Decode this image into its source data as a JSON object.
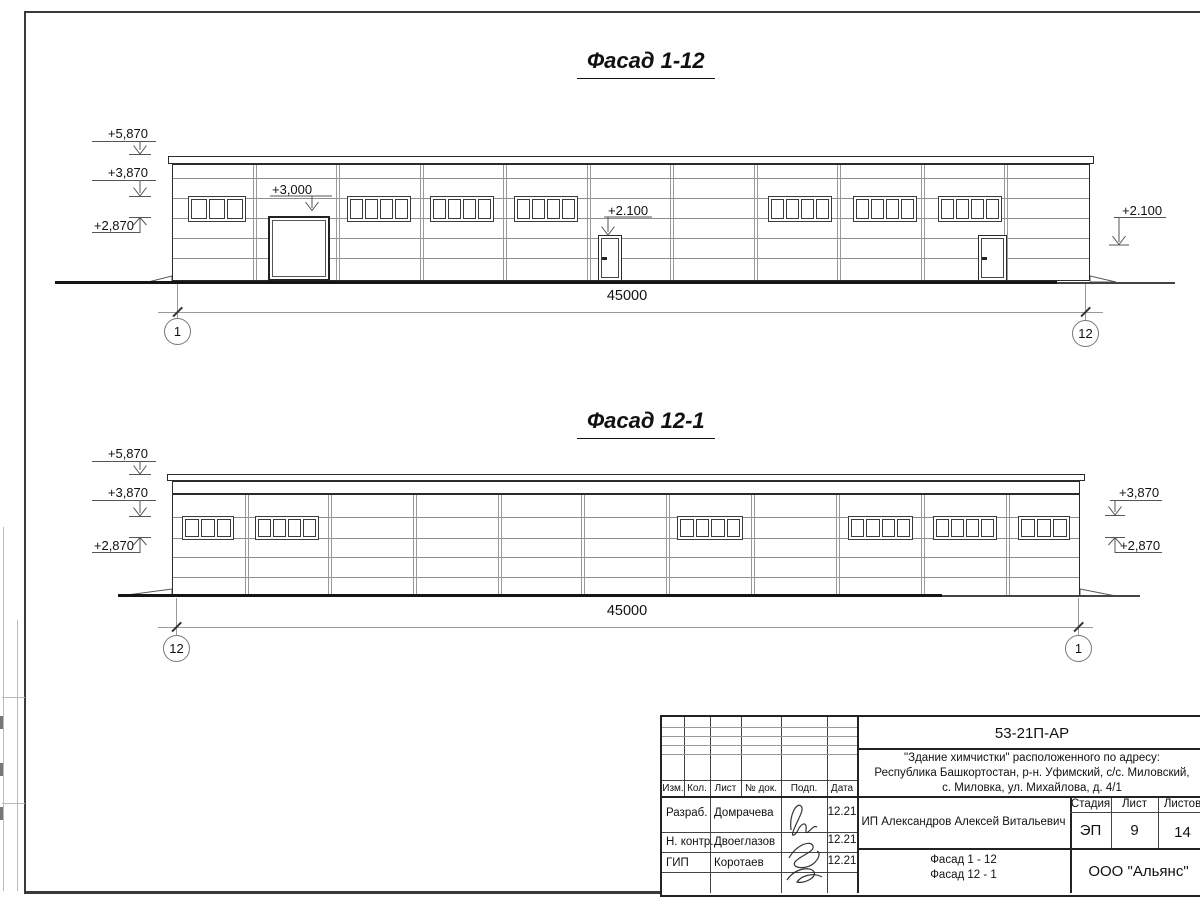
{
  "titles": {
    "facade1": "Фасад 1-12",
    "facade2": "Фасад 12-1"
  },
  "facade1": {
    "dim": "45000",
    "axis_left": "1",
    "axis_right": "12",
    "marks": {
      "m5870": "+5,870",
      "m3870": "+3,870",
      "m2870": "+2,870",
      "gate": "+3,000",
      "door": "+2.100",
      "right": "+2.100"
    }
  },
  "facade2": {
    "dim": "45000",
    "axis_left": "12",
    "axis_right": "1",
    "marks": {
      "m5870": "+5,870",
      "m3870": "+3,870",
      "m2870": "+2,870",
      "right_upper": "+3,870",
      "right_lower": "+2,870"
    }
  },
  "titleblock": {
    "doc_number": "53-21П-АР",
    "address_line1": "\"Здание химчистки\" расположенного по адресу:",
    "address_line2": "Республика Башкортостан, р-н. Уфимский, с/с. Миловский,",
    "address_line3": "с. Миловка, ул. Михайлова, д. 4/1",
    "header": {
      "izm": "Изм.",
      "kol": "Кол.",
      "list": "Лист",
      "doc": "№ док.",
      "podp": "Подп.",
      "data": "Дата"
    },
    "rows": [
      {
        "role": "Разраб.",
        "name": "Домрачева",
        "date": "12.21"
      },
      {
        "role": "Н. контр.",
        "name": "Двоеглазов",
        "date": "12.21"
      },
      {
        "role": "ГИП",
        "name": "Коротаев",
        "date": "12.21"
      }
    ],
    "client": "ИП Александров Алексей Витальевич",
    "stage_label": "Стадия",
    "sheet_label": "Лист",
    "sheets_label": "Листов",
    "stage": "ЭП",
    "sheet": "9",
    "sheets": "14",
    "drawing_name_line1": "Фасад 1 - 12",
    "drawing_name_line2": "Фасад 12 - 1",
    "company": "ООО \"Альянс\""
  }
}
